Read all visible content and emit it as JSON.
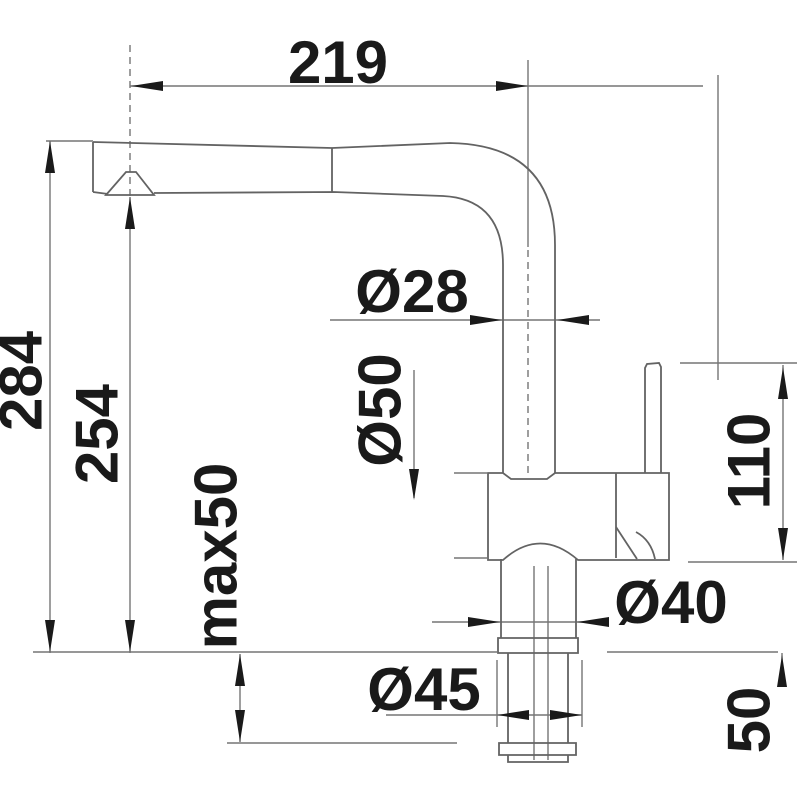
{
  "drawing": {
    "title": "faucet-dimension-drawing",
    "labels": {
      "spout_reach": "219",
      "total_height": "284",
      "spout_outlet_height": "254",
      "max_counter_thickness": "max50",
      "spout_tube_diameter": "Ø28",
      "body_diameter": "Ø50",
      "lever_height": "110",
      "neck_diameter": "Ø40",
      "hole_diameter": "Ø45",
      "under_counter_depth": "50"
    },
    "colors": {
      "line": "#757575",
      "outline": "#636363",
      "text": "#1a1a1a",
      "background": "#ffffff"
    }
  }
}
